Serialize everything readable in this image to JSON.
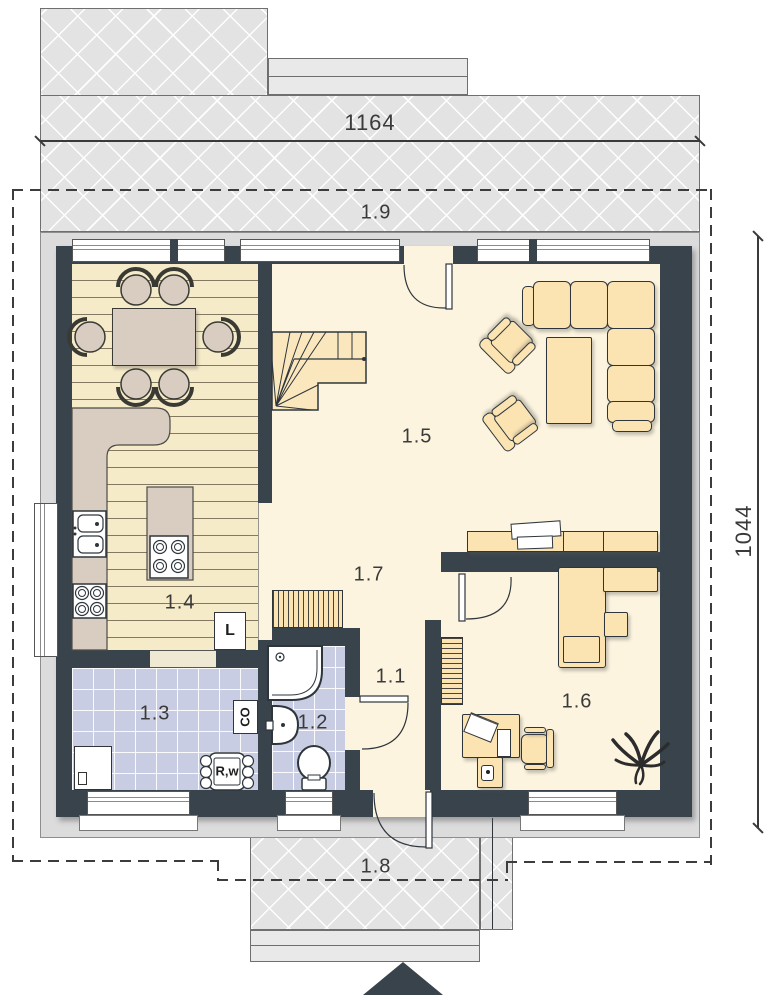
{
  "labels": {
    "dim_width": "1164",
    "dim_height": "1044"
  },
  "rooms": {
    "r11": {
      "label": "1.1"
    },
    "r12": {
      "label": "1.2"
    },
    "r13": {
      "label": "1.3"
    },
    "r14": {
      "label": "1.4"
    },
    "r15": {
      "label": "1.5"
    },
    "r16": {
      "label": "1.6"
    },
    "r17": {
      "label": "1.7"
    },
    "r18": {
      "label": "1.8"
    },
    "r19": {
      "label": "1.9"
    }
  },
  "appliances": {
    "fridge": "L",
    "boiler": "CO",
    "heater": "R,w"
  },
  "icons": {
    "entrance_marker": "entrance-arrow-icon",
    "plant": "plant-icon",
    "stairs": "stairs-icon"
  },
  "colors": {
    "wall": "#39434b",
    "floor": "#fcf4de",
    "wood": "#f6ebc9",
    "tile": "#c9cde3",
    "furniture": "#fbe3b2",
    "counter": "#d9cdc1",
    "paving": "#e3e3e4",
    "outer": "#dcdcdd",
    "line": "#3c3c3c"
  }
}
